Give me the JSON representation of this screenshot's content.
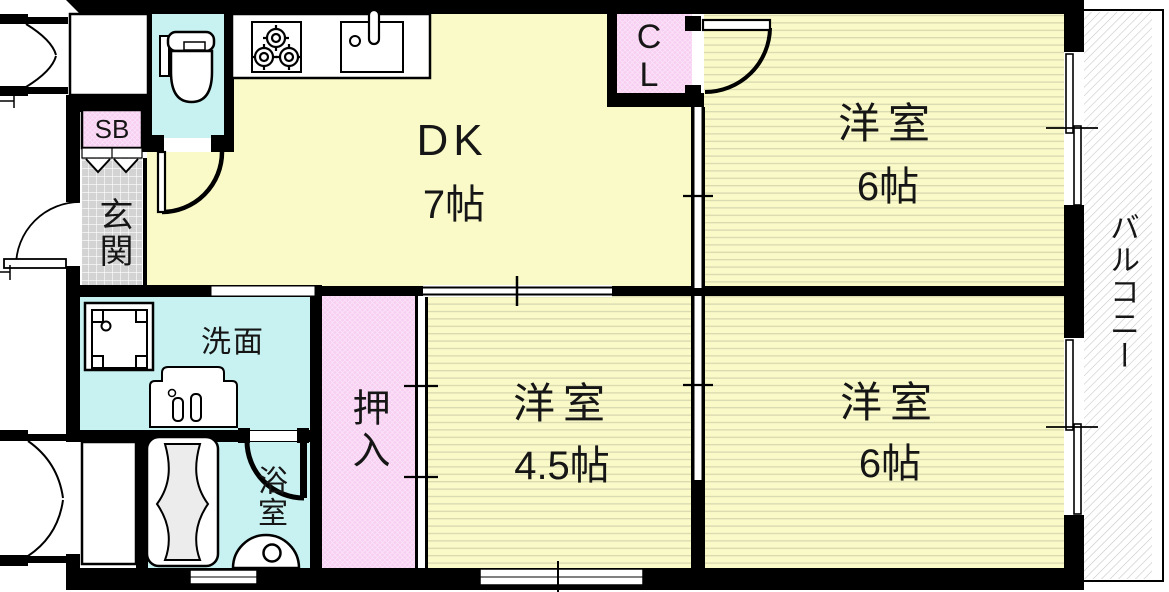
{
  "plan_title": "2DK apartment floor plan",
  "colors": {
    "wall": "#000000",
    "room_yellow": "#FAFAC8",
    "stripe_line": "#D8D8B0",
    "water_cyan": "#C8F2F2",
    "closet_pink": "#F8CEF2",
    "pink_hatch_line": "#FFFFFF",
    "tile_gray": "#D3D3D3",
    "tile_line": "#FFFFFF",
    "balcony_hatch_line": "#C8C8C8",
    "tub_gray": "#ECECEC",
    "text": "#161616"
  },
  "rooms": {
    "dk": {
      "label": "DK",
      "size": "7帖"
    },
    "bedroom_top_right": {
      "label": "洋室",
      "size": "6帖"
    },
    "bedroom_bottom_center": {
      "label": "洋室",
      "size": "4.5帖"
    },
    "bedroom_bottom_right": {
      "label": "洋室",
      "size": "6帖"
    },
    "balcony": {
      "label": "バルコニー"
    },
    "closet": {
      "label": "CL"
    },
    "shoe_box": {
      "label": "SB"
    },
    "entrance": {
      "label": "玄関"
    },
    "storage": {
      "label": "押入"
    },
    "washroom": {
      "label": "洗面"
    },
    "bathroom": {
      "label": "浴室"
    }
  },
  "fixtures": [
    "toilet-icon",
    "stove-icon",
    "kitchen-sink-icon",
    "washing-machine-icon",
    "vanity-sink-icon",
    "bathtub-icon",
    "wash-basin-icon"
  ]
}
